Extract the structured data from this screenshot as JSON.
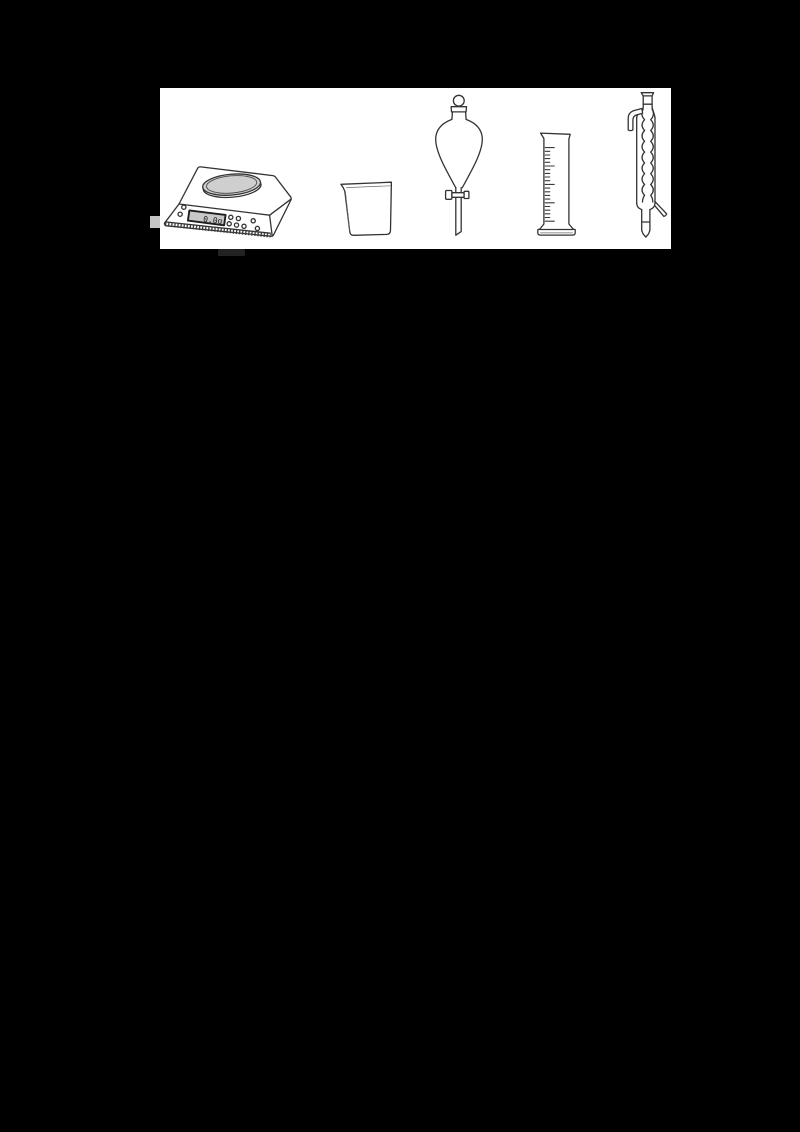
{
  "page": {
    "background": "#000000"
  },
  "figure": {
    "background": "#ffffff",
    "equipment": [
      {
        "name": "electronic-balance",
        "reading": "0.0g"
      },
      {
        "name": "beaker"
      },
      {
        "name": "separating-funnel"
      },
      {
        "name": "graduated-cylinder"
      },
      {
        "name": "bulb-condenser"
      }
    ]
  },
  "colors": {
    "line": "#333333",
    "balance_pan": "#cfcfcf",
    "balance_display": "#c8c8c8",
    "artifact_light": "#c5c5c5",
    "artifact_dark": "#222222"
  }
}
